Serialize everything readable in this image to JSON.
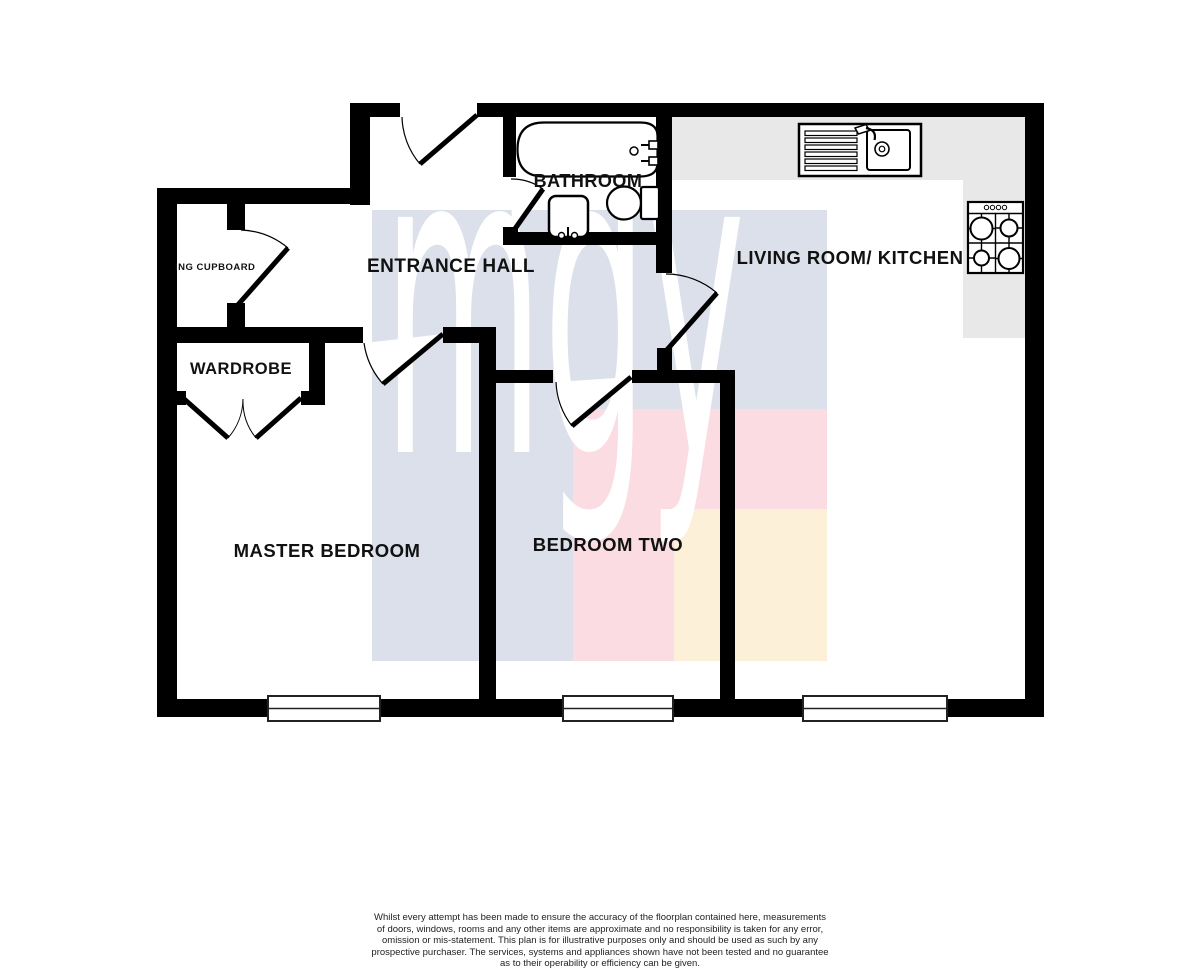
{
  "watermark": {
    "text": "mgy",
    "color": "#ffffff"
  },
  "colors": {
    "wall": "#000000",
    "counter": "#e8e8e8",
    "block_lavender": "#dbe0eb",
    "block_pink": "#fadce2",
    "block_cream": "#fdf0d8",
    "label": "#111111"
  },
  "rooms": {
    "bathroom": {
      "label": "BATHROOM"
    },
    "living_kitchen": {
      "label": "LIVING ROOM/ KITCHEN"
    },
    "entrance_hall": {
      "label": "ENTRANCE HALL"
    },
    "airing_cupboard": {
      "label": "ING CUPBOARD"
    },
    "wardrobe": {
      "label": "WARDROBE"
    },
    "master_bedroom": {
      "label": "MASTER BEDROOM"
    },
    "bedroom_two": {
      "label": "BEDROOM TWO"
    }
  },
  "icons": {
    "bathtub": "bathtub-icon",
    "toilet": "toilet-icon",
    "wash_basin": "wash-basin-icon",
    "kitchen_sink": "kitchen-sink-icon",
    "hob": "hob-icon",
    "window": "window-icon",
    "door": "door-swing-icon"
  },
  "disclaimer": {
    "lines": [
      "Whilst every attempt has been made to ensure the accuracy of the floorplan contained here, measurements",
      "of doors, windows, rooms and any other items are approximate and no responsibility is taken for any error,",
      "omission or mis-statement. This plan is for illustrative purposes only and should be used as such by any",
      "prospective purchaser. The services, systems and appliances shown have not been tested and no guarantee",
      "as to their operability or efficiency can be given.",
      "Made with Metropix ©2021"
    ]
  }
}
